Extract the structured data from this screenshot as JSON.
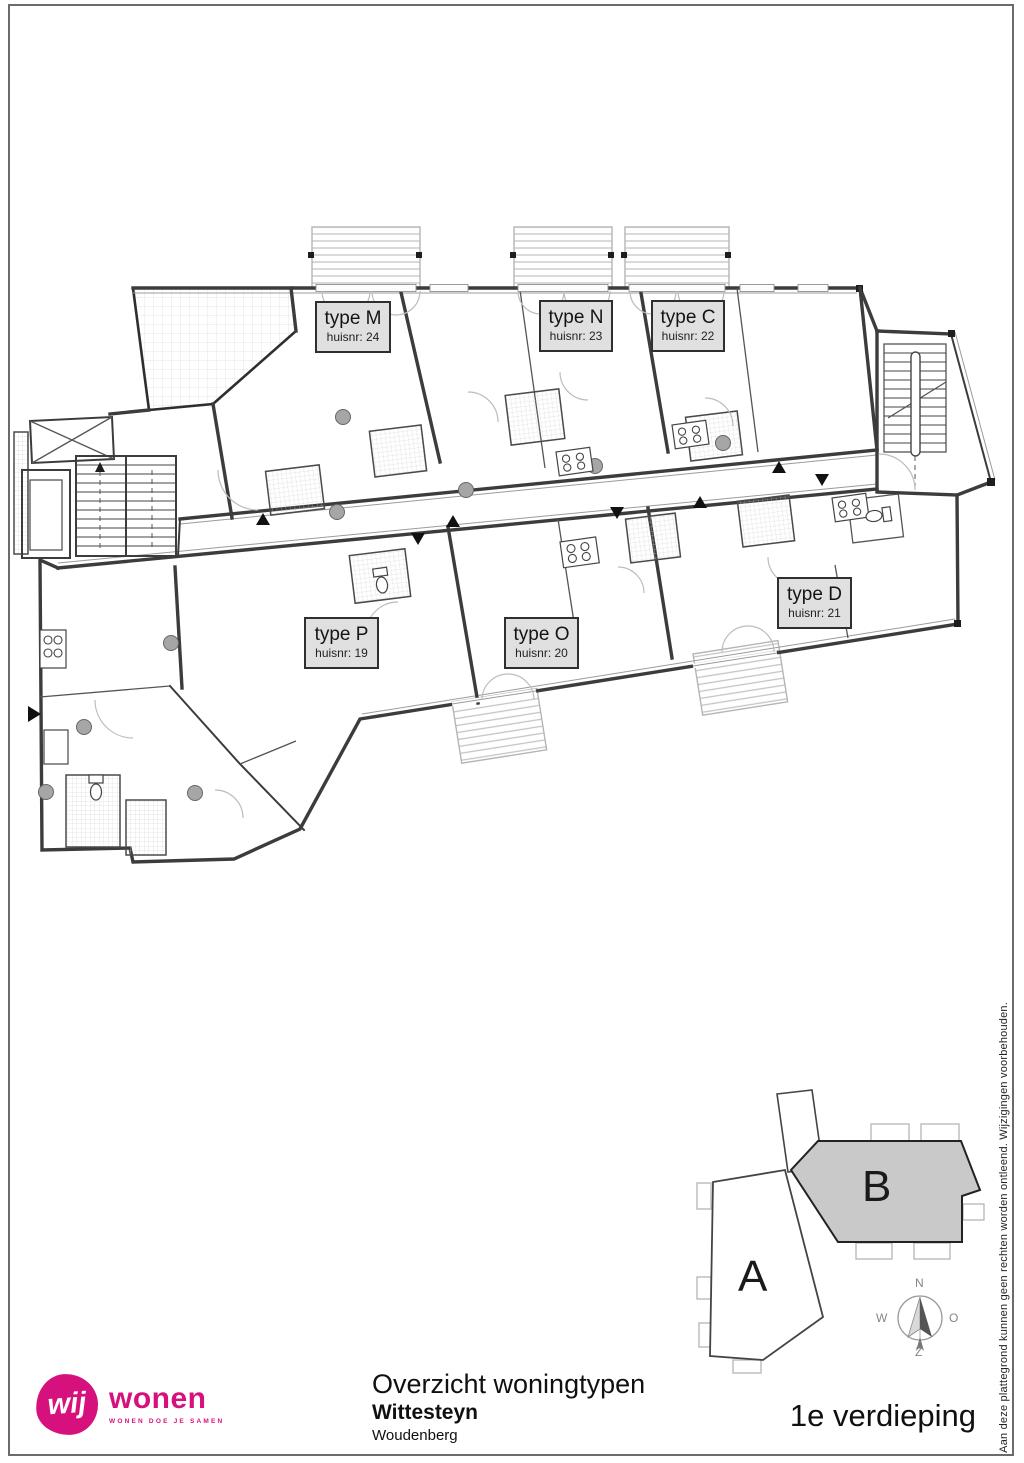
{
  "plan": {
    "units": [
      {
        "type": "type M",
        "huisnr": "huisnr: 24"
      },
      {
        "type": "type N",
        "huisnr": "huisnr: 23"
      },
      {
        "type": "type C",
        "huisnr": "huisnr: 22"
      },
      {
        "type": "type P",
        "huisnr": "huisnr: 19"
      },
      {
        "type": "type O",
        "huisnr": "huisnr: 20"
      },
      {
        "type": "type D",
        "huisnr": "huisnr: 21"
      }
    ]
  },
  "site_map": {
    "building_a_label": "A",
    "building_b_label": "B"
  },
  "compass": {
    "north": "N",
    "east": "O",
    "south": "Z",
    "west": "W"
  },
  "footer": {
    "logo_mark": "wij",
    "logo_name": "wonen",
    "logo_tagline": "WONEN DOE JE SAMEN",
    "title": "Overzicht woningtypen",
    "project": "Wittesteyn",
    "city": "Woudenberg",
    "floor": "1e verdieping"
  },
  "disclaimer": "Aan deze plattegrond kunnen geen rechten worden ontleend. Wijzigingen voorbehouden.",
  "colors": {
    "brand_pink": "#d6117e",
    "wall": "#3c3c3c",
    "label_fill": "#e0e0e0",
    "building_b_fill": "#c9c9c9"
  }
}
